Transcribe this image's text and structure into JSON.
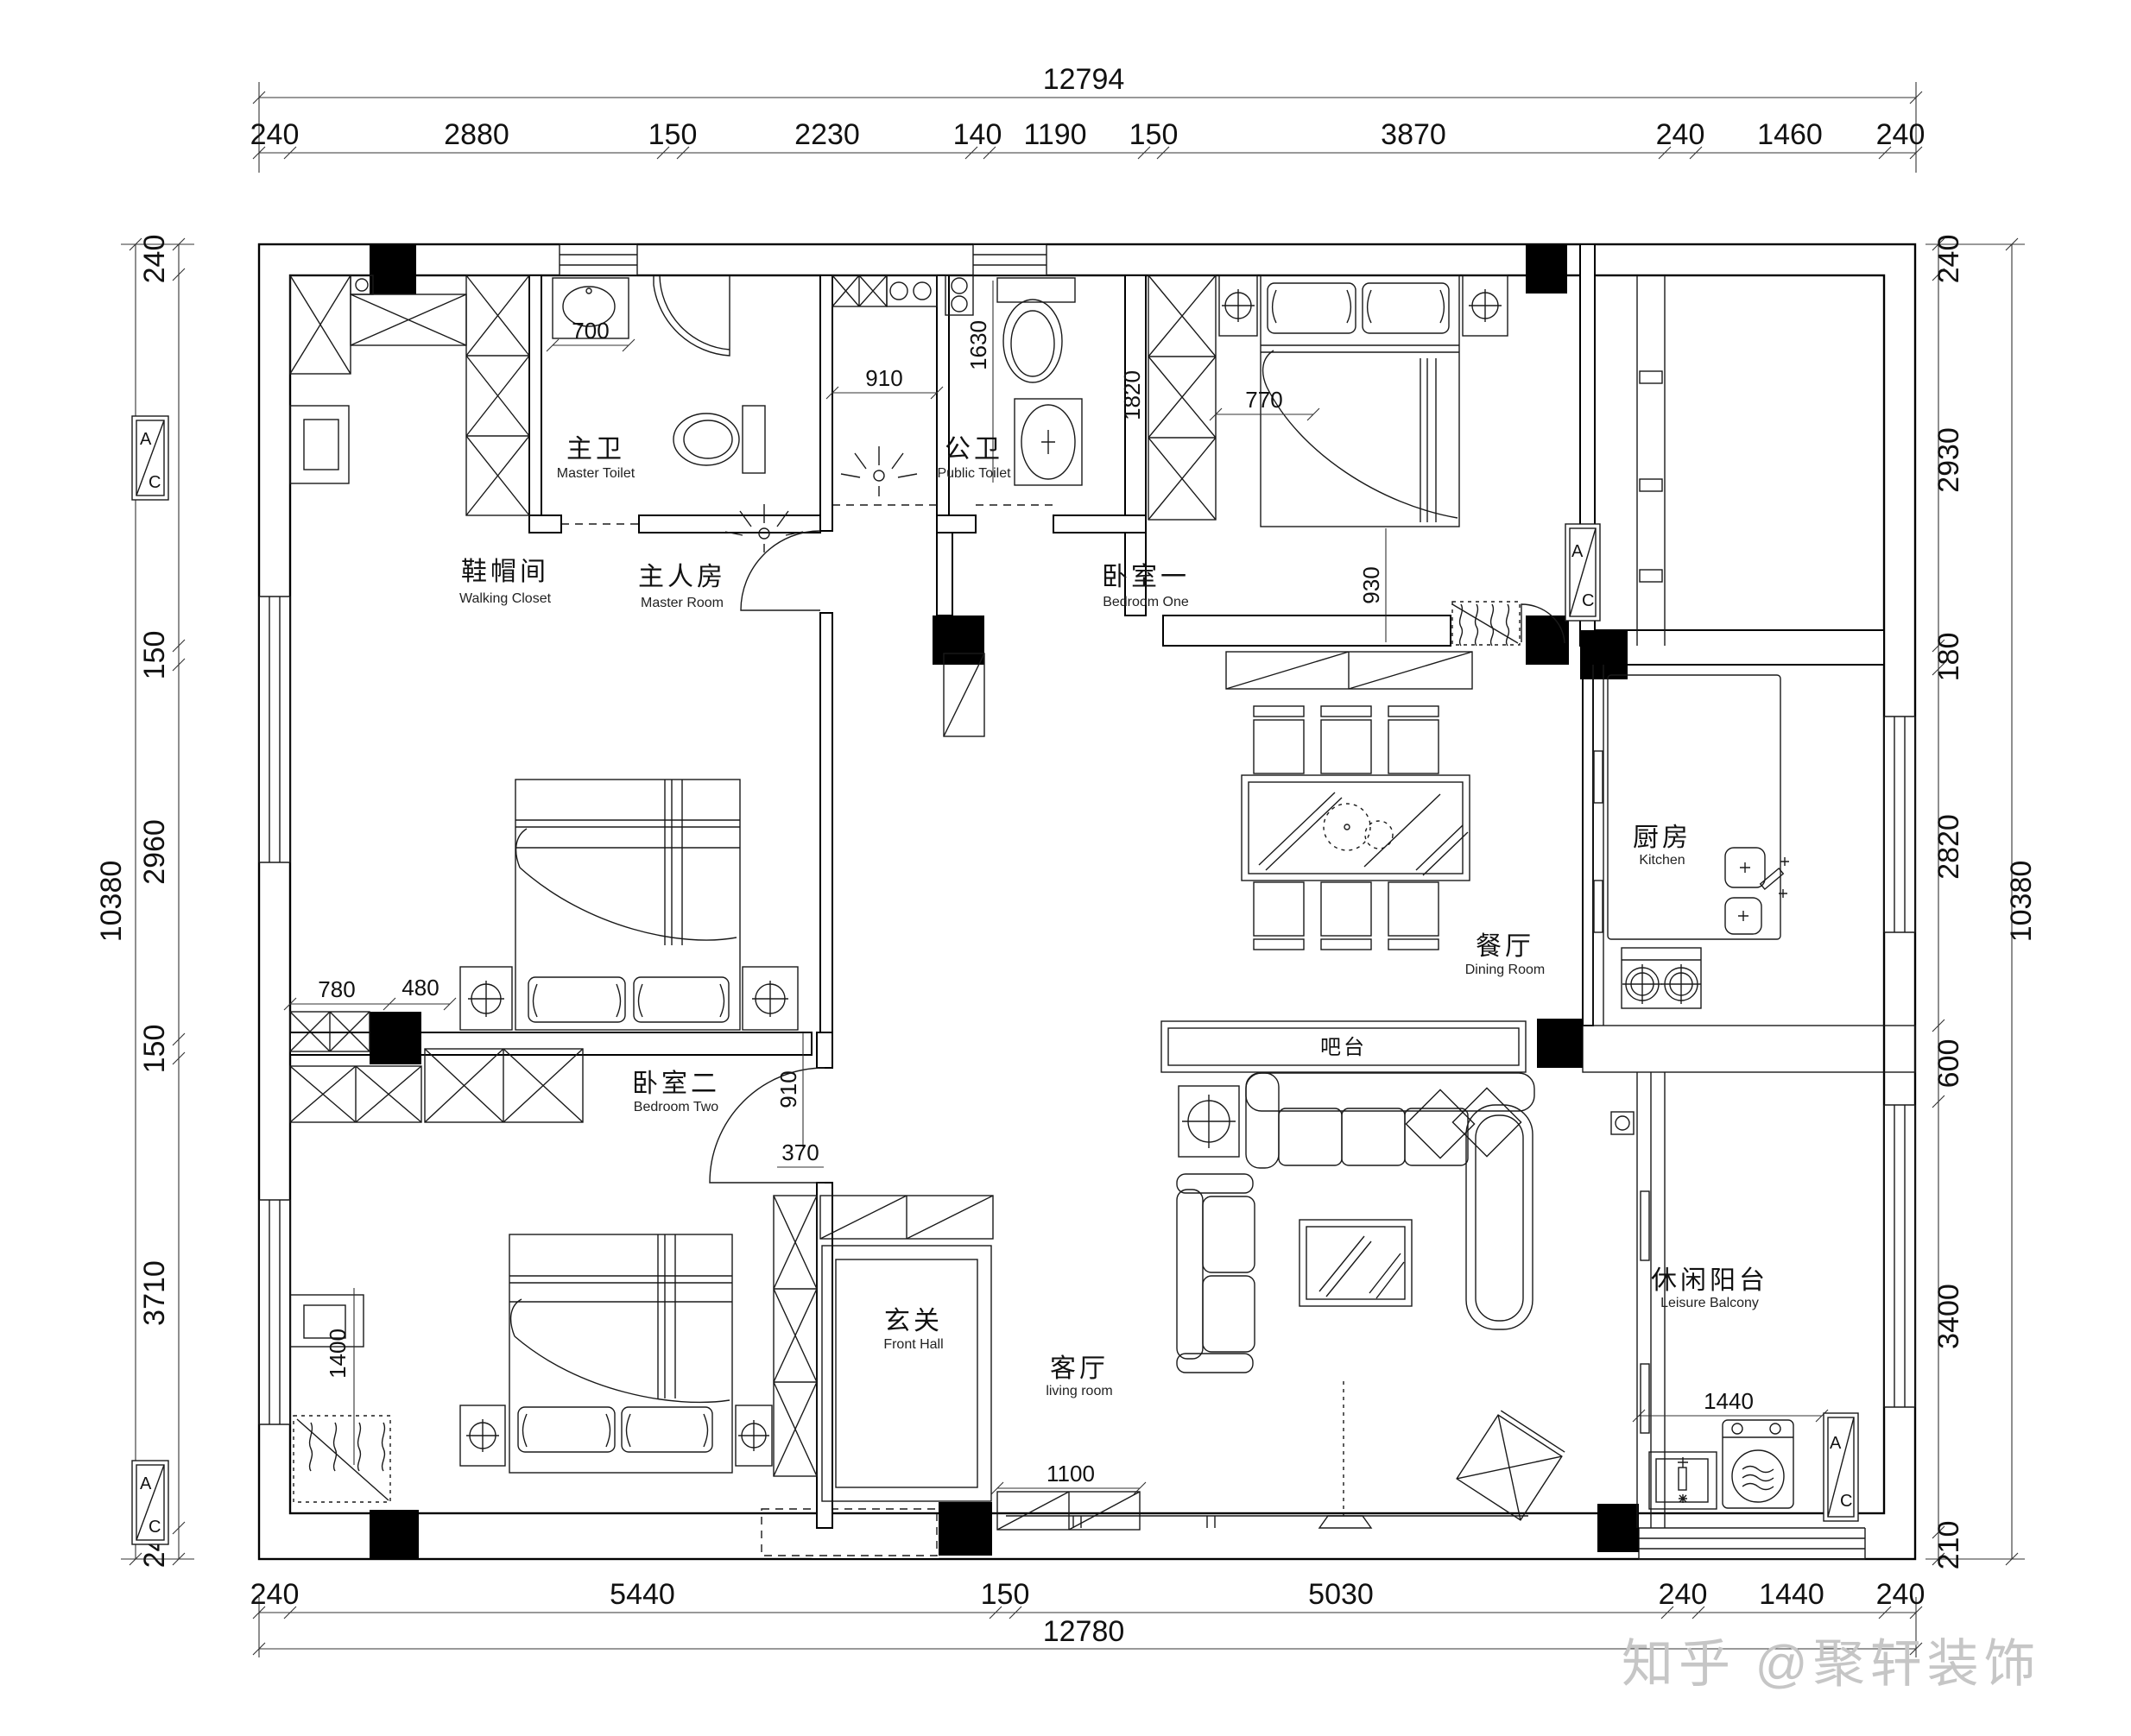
{
  "watermark": "知乎 @聚轩装饰",
  "dims": {
    "top": {
      "total": "12794",
      "segments": [
        "240",
        "2880",
        "150",
        "2230",
        "140",
        "1190",
        "150",
        "3870",
        "240",
        "1460",
        "240"
      ]
    },
    "bottom": {
      "total": "12780",
      "segments": [
        "240",
        "5440",
        "150",
        "5030",
        "240",
        "1440",
        "240"
      ]
    },
    "left": {
      "total": "10380",
      "segments": [
        "240",
        "2930",
        "150",
        "2960",
        "150",
        "3710",
        "240"
      ]
    },
    "right": {
      "total": "10380",
      "segments": [
        "240",
        "2930",
        "180",
        "2820",
        "600",
        "3400",
        "210"
      ]
    }
  },
  "interior_dims": {
    "vanity_width": "700",
    "shaft_width": "910",
    "public_toilet_depth": "1630",
    "bedroom_one_wardrobe": "1820",
    "bedroom_one_gap": "770",
    "bedroom_one_bed_gap": "930",
    "bedroom_two_dim_a": "780",
    "bedroom_two_dim_b": "480",
    "bedroom_two_side": "1400",
    "front_hall_door": "910",
    "front_hall_offset": "370",
    "entry_cabinet": "1100",
    "balcony_width": "1440"
  },
  "ac_unit": {
    "top_label": "A",
    "bottom_label": "C"
  },
  "rooms": [
    {
      "id": "walking-closet",
      "zh": "鞋帽间",
      "en": "Walking Closet"
    },
    {
      "id": "master-room",
      "zh": "主人房",
      "en": "Master Room"
    },
    {
      "id": "master-toilet",
      "zh": "主卫",
      "en": "Master Toilet"
    },
    {
      "id": "public-toilet",
      "zh": "公卫",
      "en": "Public Toilet"
    },
    {
      "id": "bedroom-one",
      "zh": "卧室一",
      "en": "Bedroom One"
    },
    {
      "id": "kitchen",
      "zh": "厨房",
      "en": "Kitchen"
    },
    {
      "id": "dining-room",
      "zh": "餐厅",
      "en": "Dining Room"
    },
    {
      "id": "bar-counter",
      "zh": "吧台",
      "en": ""
    },
    {
      "id": "bedroom-two",
      "zh": "卧室二",
      "en": "Bedroom Two"
    },
    {
      "id": "front-hall",
      "zh": "玄关",
      "en": "Front Hall"
    },
    {
      "id": "living-room",
      "zh": "客厅",
      "en": "living room"
    },
    {
      "id": "leisure-balcony",
      "zh": "休闲阳台",
      "en": "Leisure Balcony"
    }
  ]
}
